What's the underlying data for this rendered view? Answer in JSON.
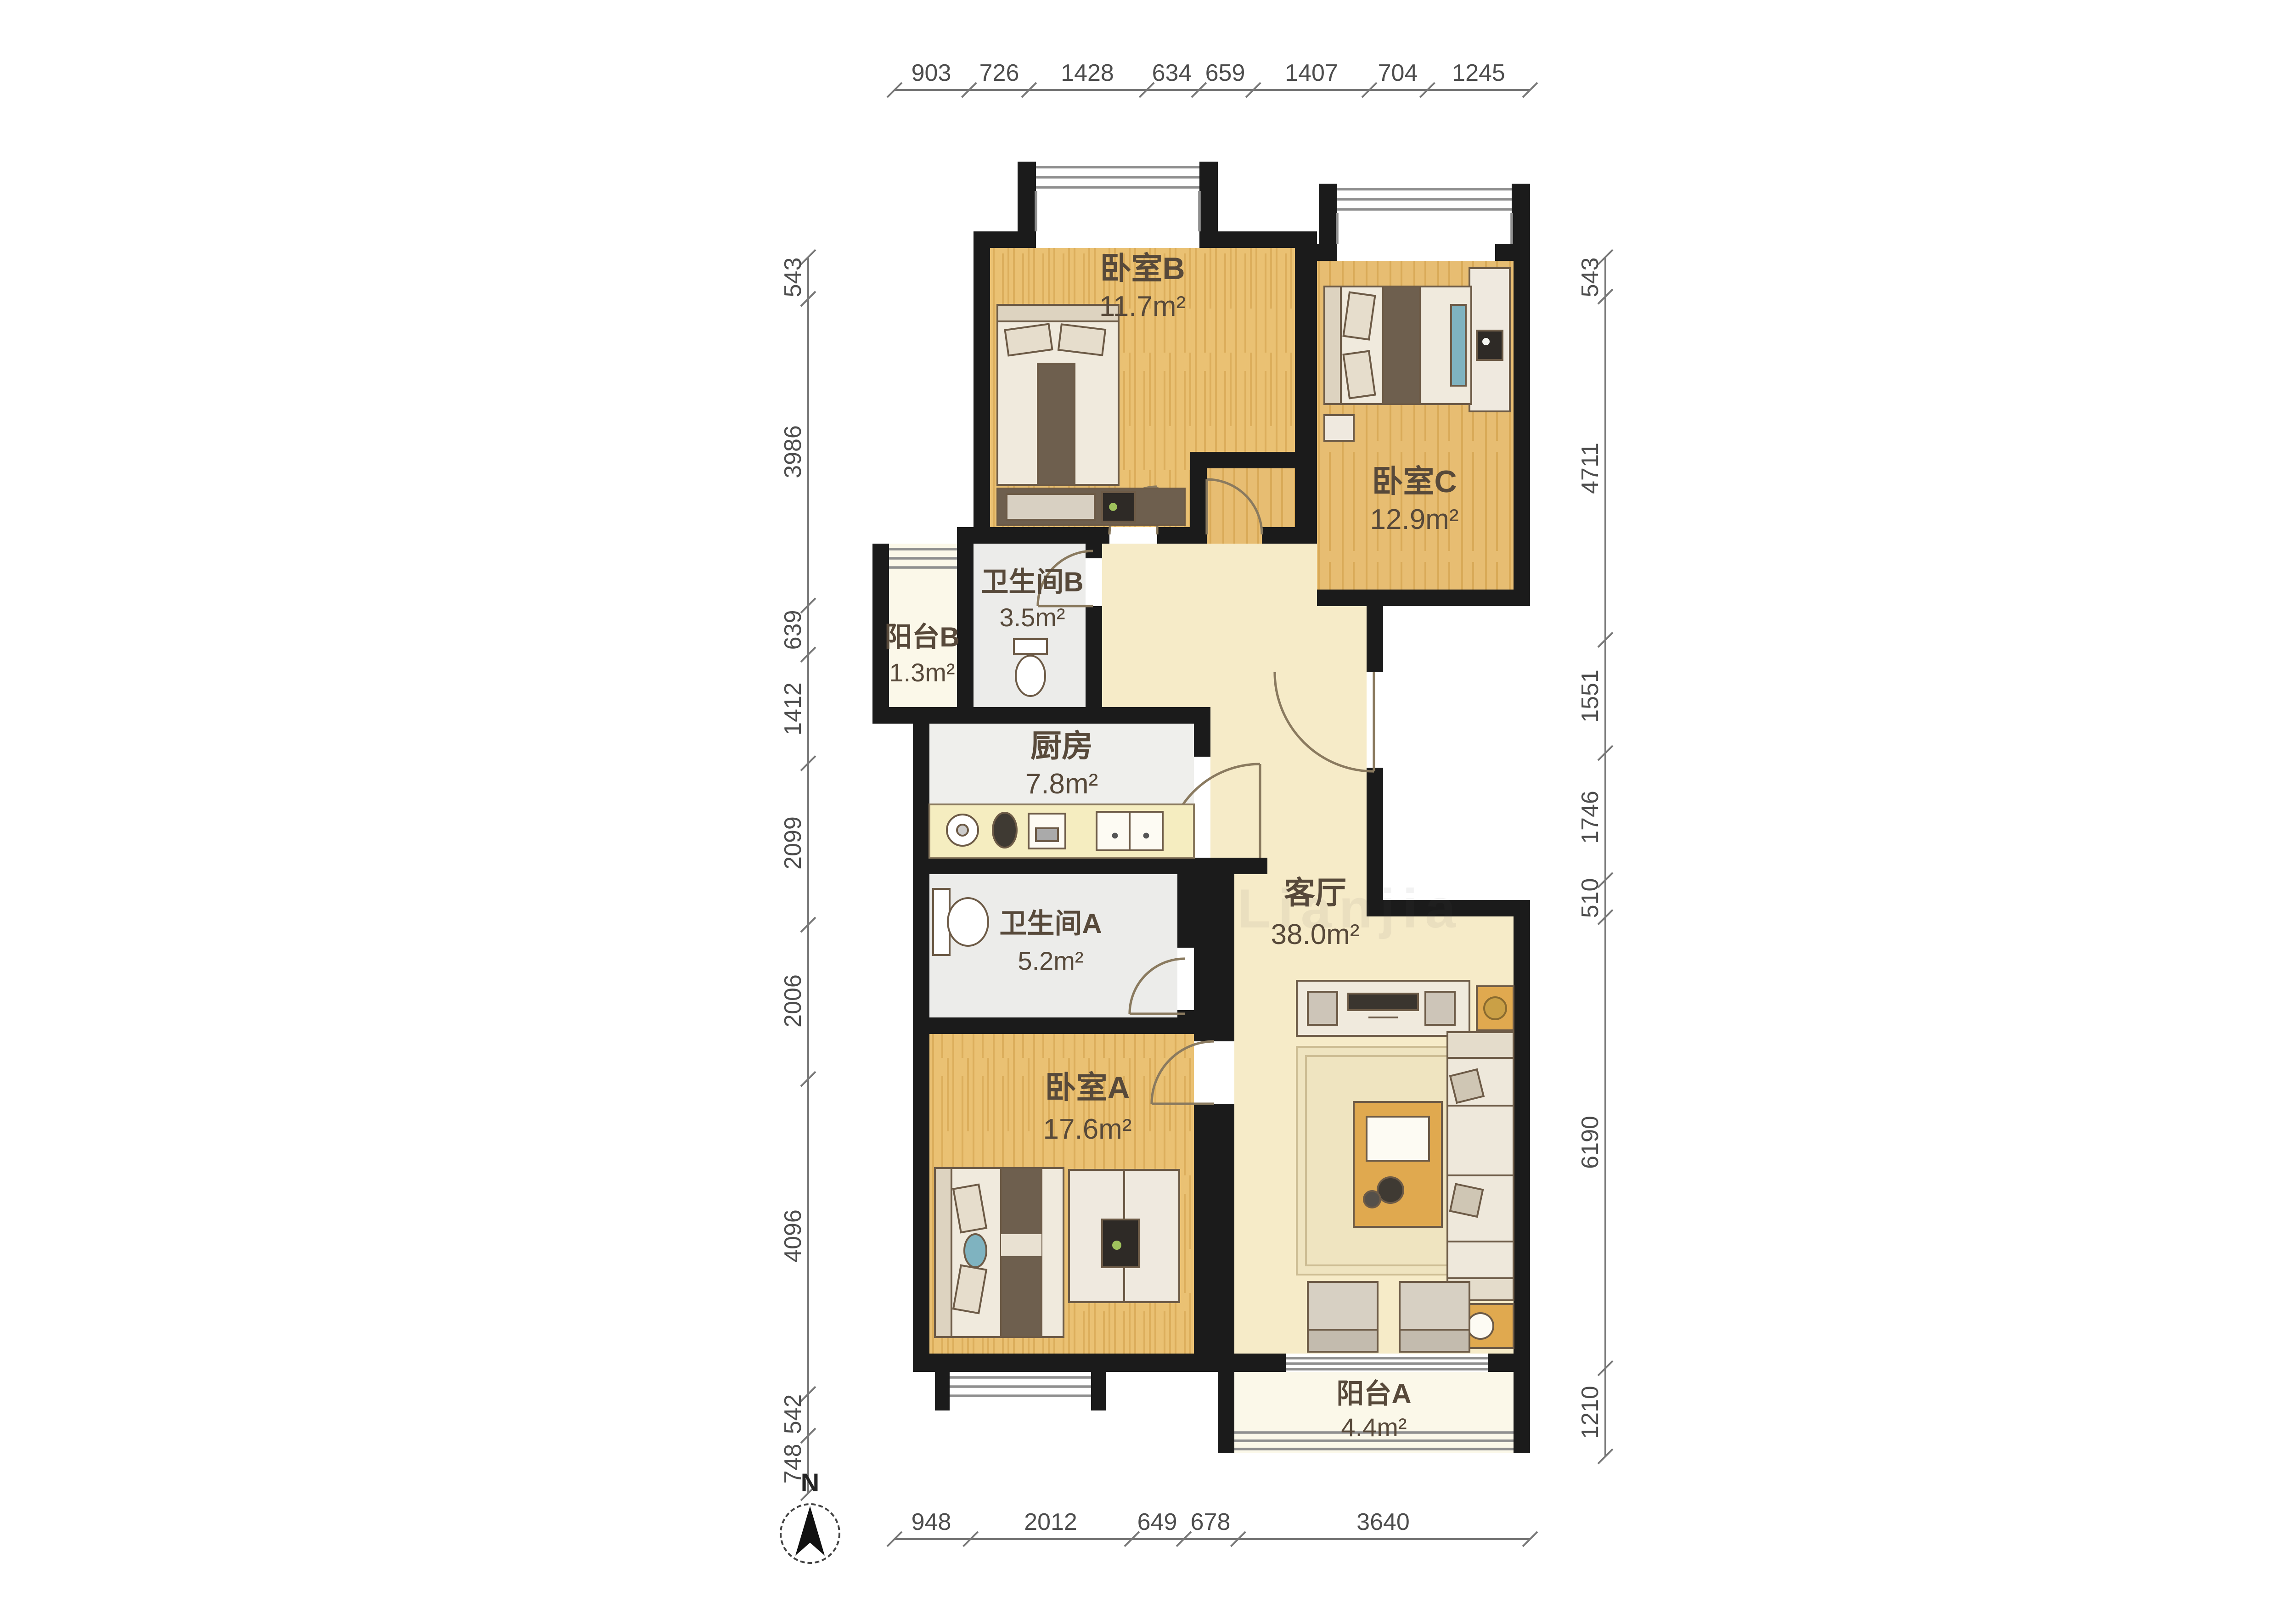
{
  "compass": {
    "north_label": "N"
  },
  "watermark": {
    "text": "Lianjia"
  },
  "rooms": {
    "bedroom_b": {
      "name": "卧室B",
      "area": "11.7m²"
    },
    "bedroom_c": {
      "name": "卧室C",
      "area": "12.9m²"
    },
    "bathroom_b": {
      "name": "卫生间B",
      "area": "3.5m²"
    },
    "balcony_b": {
      "name": "阳台B",
      "area": "1.3m²"
    },
    "kitchen": {
      "name": "厨房",
      "area": "7.8m²"
    },
    "bathroom_a": {
      "name": "卫生间A",
      "area": "5.2m²"
    },
    "bedroom_a": {
      "name": "卧室A",
      "area": "17.6m²"
    },
    "living_room": {
      "name": "客厅",
      "area": "38.0m²"
    },
    "balcony_a": {
      "name": "阳台A",
      "area": "4.4m²"
    }
  },
  "dimensions_mm": {
    "top": [
      "903",
      "726",
      "1428",
      "634",
      "659",
      "1407",
      "704",
      "1245"
    ],
    "bottom": [
      "948",
      "2012",
      "649",
      "678",
      "3640"
    ],
    "left": [
      "543",
      "3986",
      "639",
      "1412",
      "2099",
      "2006",
      "4096",
      "542",
      "748"
    ],
    "right": [
      "543",
      "4711",
      "1551",
      "1746",
      "510",
      "6190",
      "1210"
    ]
  },
  "colors": {
    "wall": "#1b1b1b",
    "wood_floor": "#eac173",
    "living_floor": "#f6ebc8",
    "tile_floor": "#ececea",
    "balcony_floor": "#fbf8e9",
    "dim_text": "#4d4d4d"
  }
}
